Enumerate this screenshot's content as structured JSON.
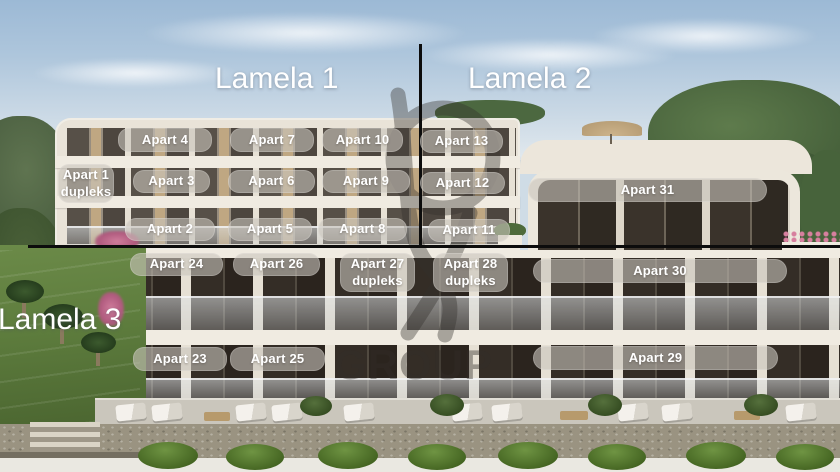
{
  "sections": [
    {
      "id": "lamela-1",
      "label": "Lamela 1"
    },
    {
      "id": "lamela-2",
      "label": "Lamela 2"
    },
    {
      "id": "lamela-3",
      "label": "Lamela 3"
    }
  ],
  "apartments": [
    {
      "id": "apart-4",
      "label": "Apart 4"
    },
    {
      "id": "apart-7",
      "label": "Apart 7"
    },
    {
      "id": "apart-10",
      "label": "Apart 10"
    },
    {
      "id": "apart-13",
      "label": "Apart 13"
    },
    {
      "id": "apart-1",
      "label": "Apart 1",
      "sublabel": "dupleks"
    },
    {
      "id": "apart-3",
      "label": "Apart 3"
    },
    {
      "id": "apart-6",
      "label": "Apart 6"
    },
    {
      "id": "apart-9",
      "label": "Apart 9"
    },
    {
      "id": "apart-12",
      "label": "Apart 12"
    },
    {
      "id": "apart-31",
      "label": "Apart 31"
    },
    {
      "id": "apart-2",
      "label": "Apart 2"
    },
    {
      "id": "apart-5",
      "label": "Apart 5"
    },
    {
      "id": "apart-8",
      "label": "Apart 8"
    },
    {
      "id": "apart-11",
      "label": "Apart 11"
    },
    {
      "id": "apart-24",
      "label": "Apart 24"
    },
    {
      "id": "apart-26",
      "label": "Apart 26"
    },
    {
      "id": "apart-27",
      "label": "Apart 27",
      "sublabel": "dupleks"
    },
    {
      "id": "apart-28",
      "label": "Apart 28",
      "sublabel": "dupleks"
    },
    {
      "id": "apart-30",
      "label": "Apart 30"
    },
    {
      "id": "apart-23",
      "label": "Apart 23"
    },
    {
      "id": "apart-25",
      "label": "Apart 25"
    },
    {
      "id": "apart-29",
      "label": "Apart 29"
    }
  ],
  "watermark": {
    "group_text": "GROUP",
    "logo": "abstract-figure-logo"
  },
  "colors": {
    "label_pill_bg": "#c9c4bc",
    "label_text": "#ffffff",
    "section_title_text": "#ffffff",
    "divider": "#0c0c0c",
    "watermark": "#38332d",
    "sky_top": "#9cb9d5",
    "facade": "#e9e3d8"
  }
}
